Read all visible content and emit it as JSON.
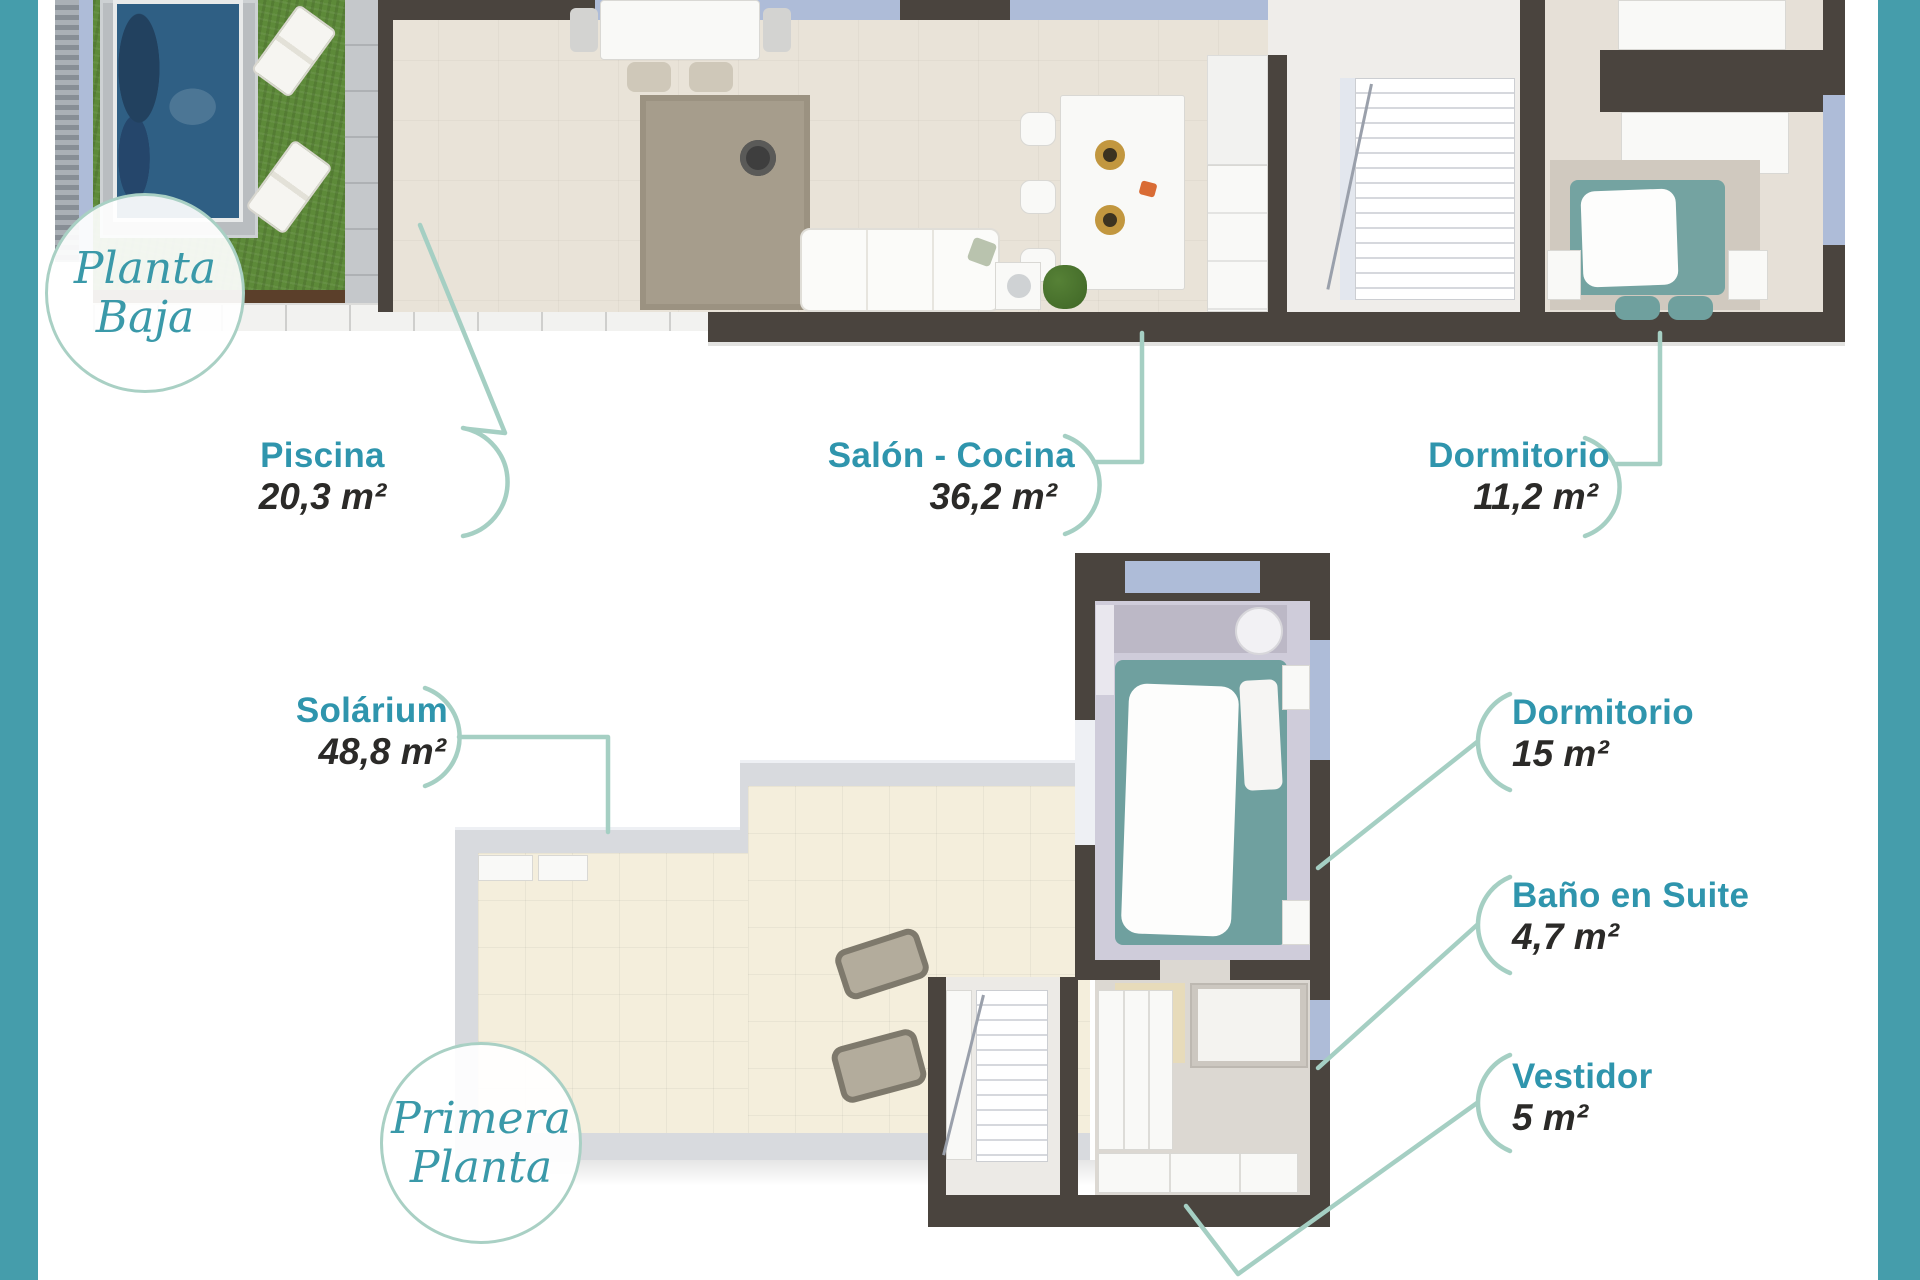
{
  "document": {
    "kind": "residential floor plan sheet",
    "language": "es"
  },
  "colors": {
    "side_stripe": "#459dab",
    "leader_line": "#a5cfc3",
    "room_name_text": "#2f95ad",
    "area_text": "#2b2a28",
    "wall": "#4a443e",
    "badge_border": "#a9d0c4",
    "badge_text": "#3a99a9",
    "pool_water": "#2f5f84",
    "grass": "#5d8a39",
    "bed": "#6fa09f"
  },
  "floors": [
    {
      "badge": {
        "line1": "Planta",
        "line2": "Baja"
      },
      "rooms": [
        {
          "name": "Piscina",
          "area": "20,3 m²"
        },
        {
          "name": "Salón - Cocina",
          "area": "36,2 m²"
        },
        {
          "name": "Dormitorio",
          "area": "11,2 m²"
        }
      ]
    },
    {
      "badge": {
        "line1": "Primera",
        "line2": "Planta"
      },
      "rooms": [
        {
          "name": "Solárium",
          "area": "48,8 m²"
        },
        {
          "name": "Dormitorio",
          "area": "15 m²"
        },
        {
          "name": "Baño en Suite",
          "area": "4,7 m²"
        },
        {
          "name": "Vestidor",
          "area": "5 m²"
        }
      ]
    }
  ]
}
